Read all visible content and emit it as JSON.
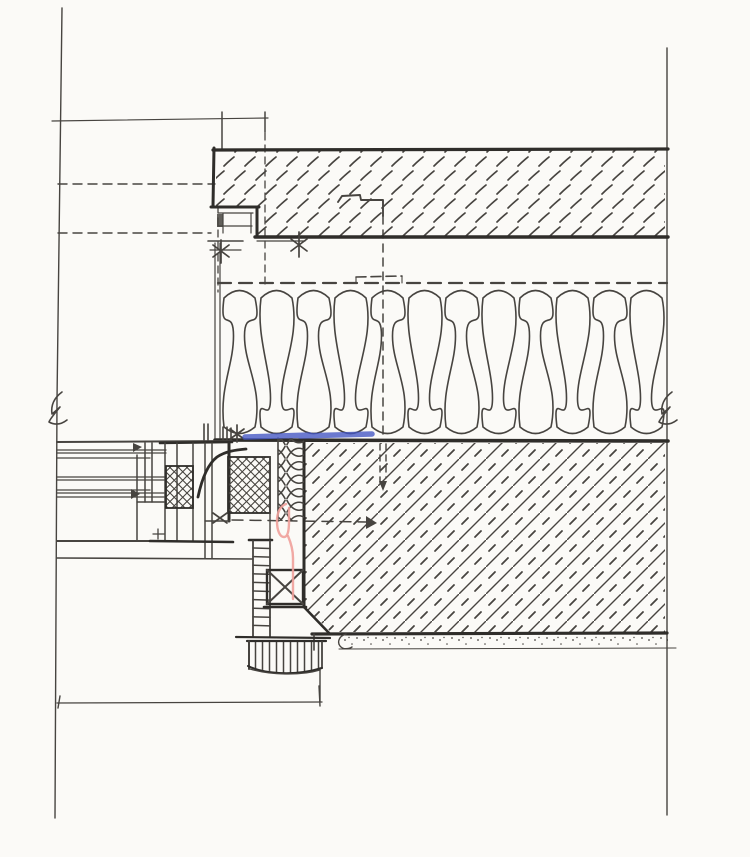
{
  "document": {
    "kind": "scanned hand-drawn construction detail",
    "subject": "window head and jamb junction at insulated masonry cavity wall, section detail",
    "visible_text": []
  },
  "colors": {
    "paper": "#fbfaf7",
    "ink": "#474440",
    "ink_heavy": "#2f2d2a",
    "highlight_blue": "#4254c4",
    "highlight_pink": "#efa09a"
  },
  "symbols": {
    "break_marks": 2,
    "asterisk_anchors": 2,
    "cross_anchors": 2,
    "arrowheads": 2
  },
  "geometry": {
    "insulation": {
      "left": 221,
      "cell_width": 37,
      "strands": 12,
      "top": 286,
      "bottom": 438,
      "pinch_high": 336,
      "pinch_low": 398
    },
    "ladder_strip": {
      "x1": 253,
      "x2": 270,
      "rung_start": 548,
      "rung_end": 634,
      "rung_step": 8.6
    },
    "glazing_lines": {
      "x1": 57,
      "lines": [
        {
          "y": 450,
          "x2": 166
        },
        {
          "y": 453,
          "x2": 166
        },
        {
          "y": 458,
          "x2": 150
        },
        {
          "y": 477,
          "x2": 166
        },
        {
          "y": 480,
          "x2": 166
        },
        {
          "y": 490,
          "x2": 150
        },
        {
          "y": 493,
          "x2": 164
        },
        {
          "y": 497,
          "x2": 164
        }
      ]
    }
  }
}
